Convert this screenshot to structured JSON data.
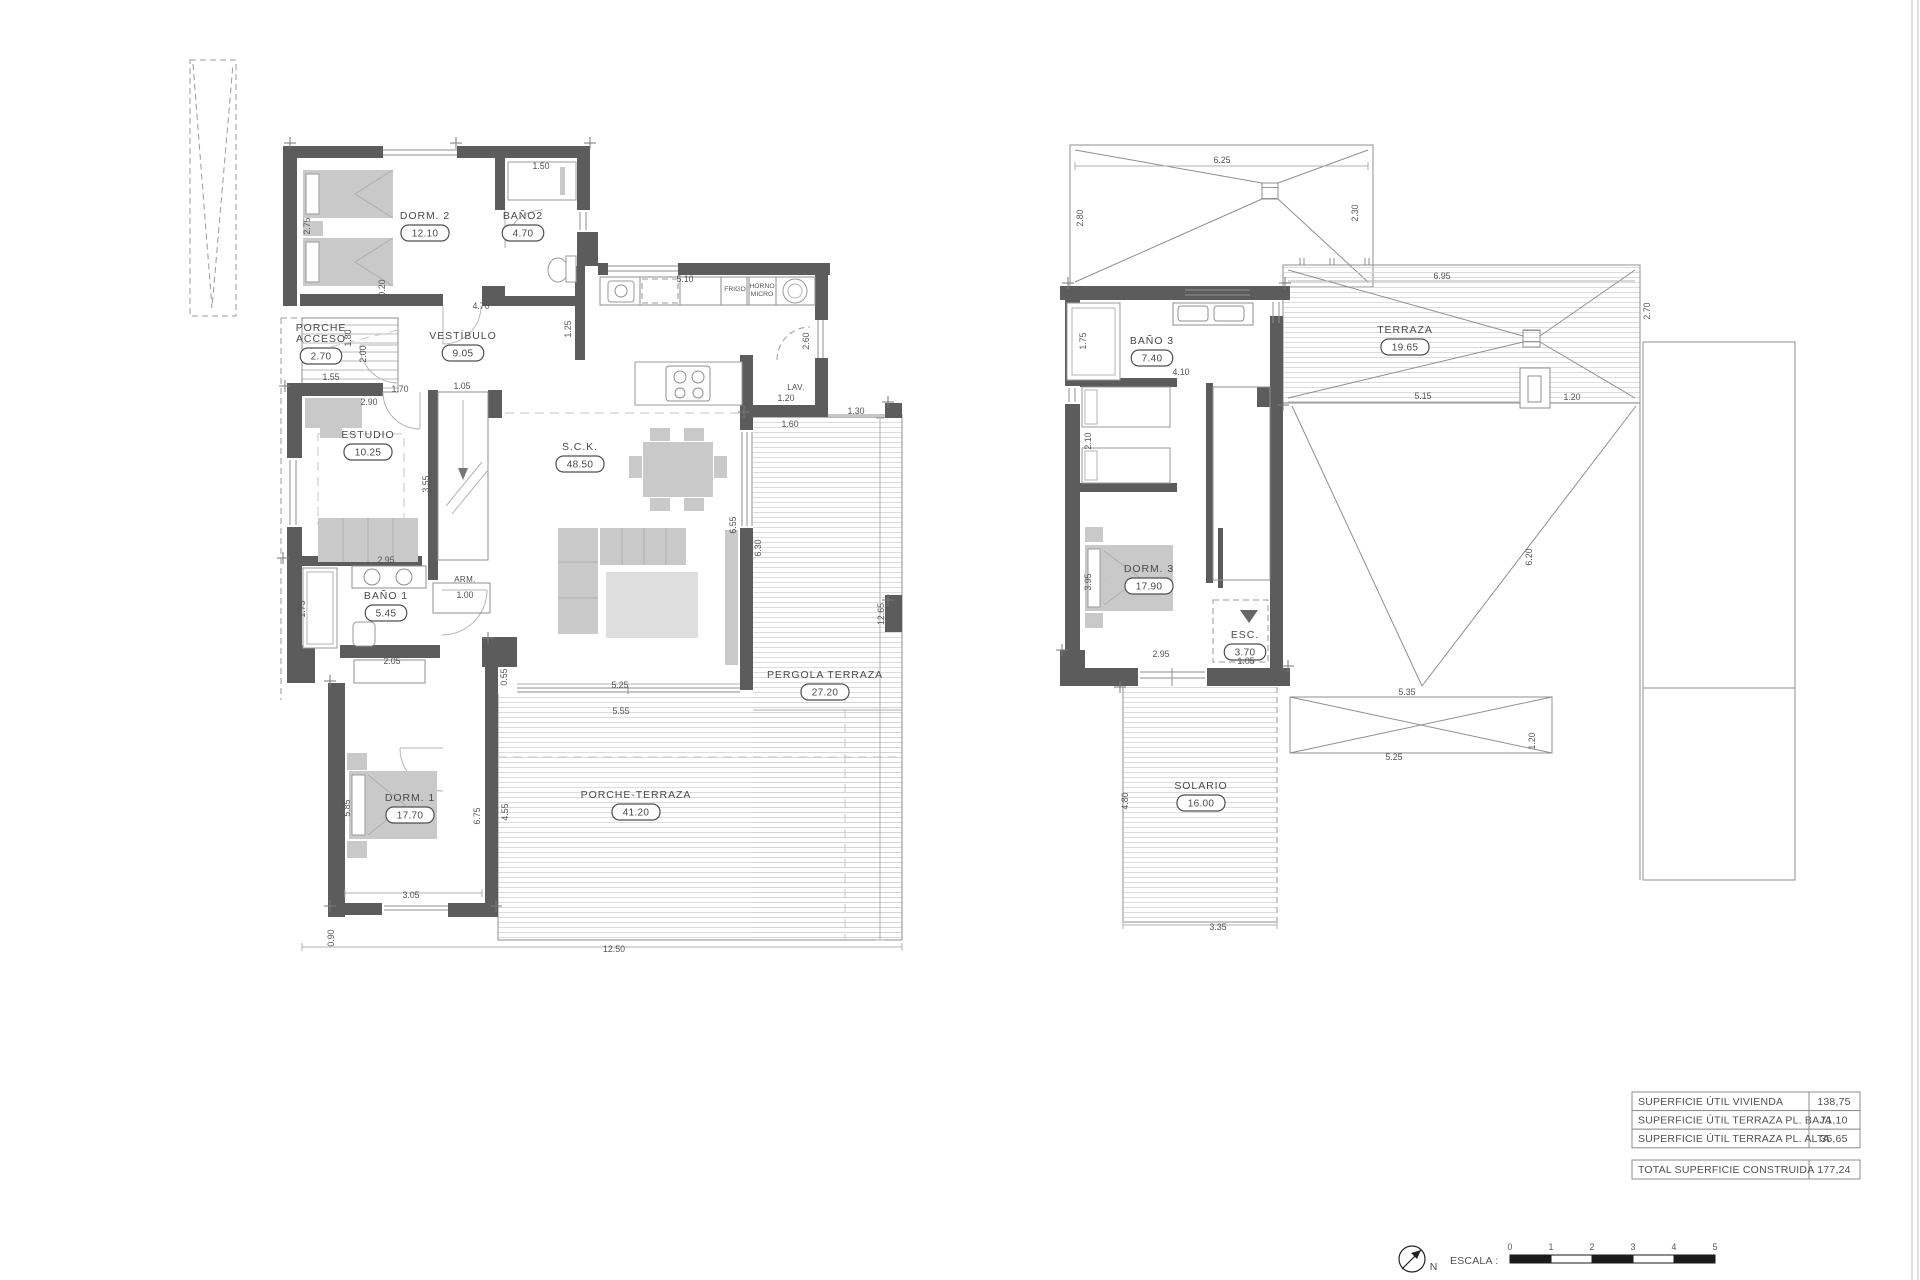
{
  "ground_floor": {
    "rooms": [
      {
        "label": "DORM. 2",
        "area": "12.10",
        "x": 425,
        "y": 219
      },
      {
        "label": "BAÑO2",
        "area": "4.70",
        "x": 523,
        "y": 219
      },
      {
        "label": "PORCHE",
        "label2": "ACCESO",
        "area": "2.70",
        "x": 321,
        "y": 331
      },
      {
        "label": "VESTÍBULO",
        "area": "9.05",
        "x": 463,
        "y": 339
      },
      {
        "label": "ESTUDIO",
        "area": "10.25",
        "x": 368,
        "y": 438
      },
      {
        "label": "BAÑO 1",
        "area": "5.45",
        "x": 386,
        "y": 599
      },
      {
        "label": "S.C.K.",
        "area": "48.50",
        "x": 580,
        "y": 450
      },
      {
        "label": "DORM. 1",
        "area": "17.70",
        "x": 410,
        "y": 801
      },
      {
        "label": "PERGOLA TERRAZA",
        "area": "27.20",
        "x": 825,
        "y": 678
      },
      {
        "label": "PORCHE-TERRAZA",
        "area": "41.20",
        "x": 636,
        "y": 798
      }
    ],
    "annotations": [
      {
        "t": "ARM.",
        "x": 465,
        "y": 582
      },
      {
        "t": "LAV.",
        "x": 796,
        "y": 390
      },
      {
        "t": "FRIGO",
        "x": 735,
        "y": 291,
        "s": 1
      },
      {
        "t": "HORNO",
        "x": 762,
        "y": 288,
        "s": 1
      },
      {
        "t": "MICRO",
        "x": 762,
        "y": 296,
        "s": 1
      }
    ],
    "dims": [
      {
        "t": "1.50",
        "x": 541,
        "y": 169
      },
      {
        "t": "2.75",
        "x": 310,
        "y": 226,
        "r": 1
      },
      {
        "t": "0.20",
        "x": 385,
        "y": 288,
        "r": 1
      },
      {
        "t": "4.70",
        "x": 481,
        "y": 309
      },
      {
        "t": "5.10",
        "x": 685,
        "y": 282
      },
      {
        "t": "1.25",
        "x": 571,
        "y": 329,
        "r": 1
      },
      {
        "t": "2.60",
        "x": 809,
        "y": 341,
        "r": 1
      },
      {
        "t": "1.20",
        "x": 786,
        "y": 401
      },
      {
        "t": "1.30",
        "x": 856,
        "y": 414
      },
      {
        "t": "1.60",
        "x": 790,
        "y": 427
      },
      {
        "t": "1.00",
        "x": 465,
        "y": 598
      },
      {
        "t": "1.55",
        "x": 331,
        "y": 380
      },
      {
        "t": "1.70",
        "x": 400,
        "y": 392
      },
      {
        "t": "1.80",
        "x": 351,
        "y": 338,
        "r": 1
      },
      {
        "t": "2.00",
        "x": 366,
        "y": 354,
        "r": 1
      },
      {
        "t": "1.05",
        "x": 462,
        "y": 389
      },
      {
        "t": "2.90",
        "x": 369,
        "y": 405
      },
      {
        "t": "3.55",
        "x": 429,
        "y": 484,
        "r": 1
      },
      {
        "t": "2.95",
        "x": 386,
        "y": 563
      },
      {
        "t": "1.75",
        "x": 305,
        "y": 609,
        "r": 1
      },
      {
        "t": "2.05",
        "x": 392,
        "y": 664
      },
      {
        "t": "0.55",
        "x": 507,
        "y": 677,
        "r": 1
      },
      {
        "t": "5.25",
        "x": 620,
        "y": 688
      },
      {
        "t": "5.55",
        "x": 621,
        "y": 714
      },
      {
        "t": "6.55",
        "x": 736,
        "y": 525,
        "r": 1
      },
      {
        "t": "6.30",
        "x": 761,
        "y": 548,
        "r": 1
      },
      {
        "t": "12.65",
        "x": 884,
        "y": 614,
        "r": 1
      },
      {
        "t": "5.85",
        "x": 350,
        "y": 808,
        "r": 1
      },
      {
        "t": "6.75",
        "x": 480,
        "y": 816,
        "r": 1
      },
      {
        "t": "4.55",
        "x": 508,
        "y": 812,
        "r": 1
      },
      {
        "t": "3.05",
        "x": 411,
        "y": 898
      },
      {
        "t": "0.90",
        "x": 334,
        "y": 938,
        "r": 1
      },
      {
        "t": "12.50",
        "x": 614,
        "y": 952
      }
    ]
  },
  "upper_floor": {
    "rooms": [
      {
        "label": "BAÑO 3",
        "area": "7.40",
        "x": 1152,
        "y": 344
      },
      {
        "label": "TERRAZA",
        "area": "19.65",
        "x": 1405,
        "y": 333
      },
      {
        "label": "DORM. 3",
        "area": "17.90",
        "x": 1149,
        "y": 572
      },
      {
        "label": "ESC.",
        "area": "3.70",
        "x": 1245,
        "y": 638
      },
      {
        "label": "SOLARIO",
        "area": "16.00",
        "x": 1201,
        "y": 789
      }
    ],
    "annotations": [],
    "dims": [
      {
        "t": "6.25",
        "x": 1222,
        "y": 163
      },
      {
        "t": "2.80",
        "x": 1083,
        "y": 218,
        "r": 1
      },
      {
        "t": "2.30",
        "x": 1358,
        "y": 213,
        "r": 1
      },
      {
        "t": "6.95",
        "x": 1442,
        "y": 279
      },
      {
        "t": "2.70",
        "x": 1650,
        "y": 311,
        "r": 1
      },
      {
        "t": "1.75",
        "x": 1086,
        "y": 341,
        "r": 1
      },
      {
        "t": "4.10",
        "x": 1181,
        "y": 375
      },
      {
        "t": "2.10",
        "x": 1091,
        "y": 441,
        "r": 1
      },
      {
        "t": "5.15",
        "x": 1423,
        "y": 399
      },
      {
        "t": "1.20",
        "x": 1572,
        "y": 400
      },
      {
        "t": "3.95",
        "x": 1091,
        "y": 582,
        "r": 1
      },
      {
        "t": "6.20",
        "x": 1532,
        "y": 557,
        "r": 1
      },
      {
        "t": "2.95",
        "x": 1161,
        "y": 657
      },
      {
        "t": "1.05",
        "x": 1246,
        "y": 664
      },
      {
        "t": "5.35",
        "x": 1407,
        "y": 695
      },
      {
        "t": "5.25",
        "x": 1394,
        "y": 760
      },
      {
        "t": "1.20",
        "x": 1535,
        "y": 741,
        "r": 1
      },
      {
        "t": "4.80",
        "x": 1128,
        "y": 801,
        "r": 1
      },
      {
        "t": "3.35",
        "x": 1218,
        "y": 930
      }
    ]
  },
  "summary_table": {
    "rows": [
      {
        "label": "SUPERFICIE ÚTIL VIVIENDA",
        "value": "138,75"
      },
      {
        "label": "SUPERFICIE ÚTIL TERRAZA PL. BAJA",
        "value": "71,10"
      },
      {
        "label": "SUPERFICIE ÚTIL TERRAZA PL. ALTA",
        "value": "35,65"
      }
    ],
    "total": {
      "label": "TOTAL SUPERFICIE CONSTRUIDA",
      "value": "177,24"
    }
  },
  "scale_bar": {
    "label": "ESCALA :",
    "north": "N",
    "ticks": [
      "0",
      "1",
      "2",
      "3",
      "4",
      "5"
    ]
  }
}
